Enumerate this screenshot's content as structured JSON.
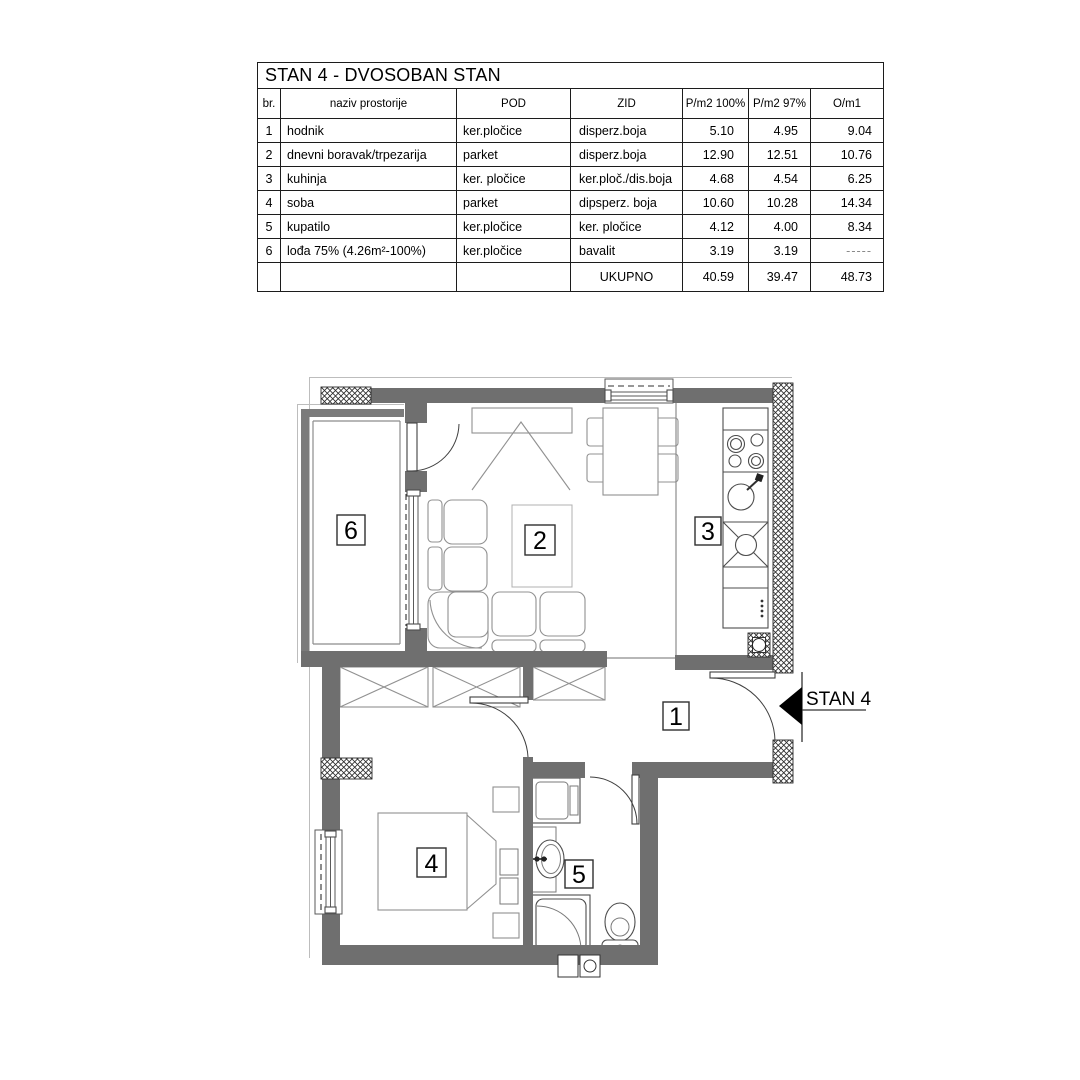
{
  "table": {
    "title": "STAN 4 - DVOSOBAN STAN",
    "columns": {
      "br": "br.",
      "naziv": "naziv prostorije",
      "pod": "POD",
      "zid": "ZID",
      "p100": "P/m2 100%",
      "p97": "P/m2 97%",
      "o": "O/m1"
    },
    "rows": [
      {
        "br": "1",
        "naziv": "hodnik",
        "pod": "ker.pločice",
        "zid": "disperz.boja",
        "p100": "5.10",
        "p97": "4.95",
        "o": "9.04"
      },
      {
        "br": "2",
        "naziv": "dnevni boravak/trpezarija",
        "pod": "parket",
        "zid": "disperz.boja",
        "p100": "12.90",
        "p97": "12.51",
        "o": "10.76"
      },
      {
        "br": "3",
        "naziv": "kuhinja",
        "pod": "ker. pločice",
        "zid": "ker.ploč./dis.boja",
        "p100": "4.68",
        "p97": "4.54",
        "o": "6.25"
      },
      {
        "br": "4",
        "naziv": "soba",
        "pod": "parket",
        "zid": "dipsperz. boja",
        "p100": "10.60",
        "p97": "10.28",
        "o": "14.34"
      },
      {
        "br": "5",
        "naziv": "kupatilo",
        "pod": "ker.pločice",
        "zid": "ker. pločice",
        "p100": "4.12",
        "p97": "4.00",
        "o": "8.34"
      },
      {
        "br": "6",
        "naziv": "lođa 75% (4.26m²-100%)",
        "pod": "ker.pločice",
        "zid": "bavalit",
        "p100": "3.19",
        "p97": "3.19",
        "o": "-----"
      }
    ],
    "total": {
      "label": "UKUPNO",
      "p100": "40.59",
      "p97": "39.47",
      "o": "48.73"
    }
  },
  "plan": {
    "rooms": {
      "hallway": "1",
      "living": "2",
      "kitchen": "3",
      "bedroom": "4",
      "bathroom": "5",
      "loggia": "6"
    },
    "entrance_label": "STAN 4",
    "colors": {
      "wall": "#6f6f6f",
      "furniture_line": "#919191"
    }
  }
}
